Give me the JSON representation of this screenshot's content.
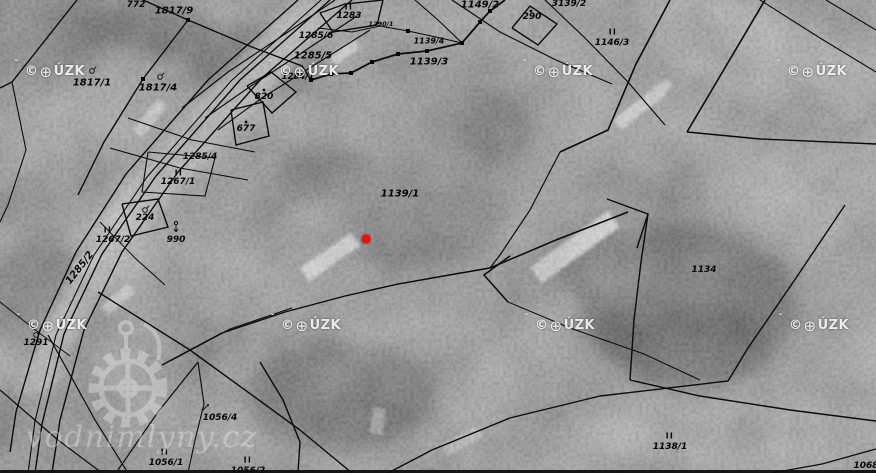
{
  "map": {
    "marker": {
      "x": 366,
      "y": 239,
      "color": "#f40d0d"
    },
    "copyright": {
      "prefix": "©",
      "globe_icon": "⊕",
      "caron": "ˇ",
      "suffix": "ÚZK",
      "positions": [
        {
          "x": 25,
          "y": 64
        },
        {
          "x": 279,
          "y": 64
        },
        {
          "x": 533,
          "y": 64
        },
        {
          "x": 787,
          "y": 64
        },
        {
          "x": 27,
          "y": 318
        },
        {
          "x": 281,
          "y": 318
        },
        {
          "x": 535,
          "y": 318
        },
        {
          "x": 789,
          "y": 318
        }
      ]
    },
    "site_watermark": {
      "text": "vodnimlyny.cz"
    },
    "parcel_labels": [
      {
        "text": "772",
        "x": 136,
        "y": 5
      },
      {
        "text": "1817/9",
        "x": 174,
        "y": 11,
        "size": 10
      },
      {
        "text": "1817/1",
        "x": 92,
        "y": 83,
        "size": 10
      },
      {
        "text": "1817/4",
        "x": 158,
        "y": 88,
        "size": 10
      },
      {
        "text": "820",
        "x": 264,
        "y": 97
      },
      {
        "text": "677",
        "x": 246,
        "y": 129
      },
      {
        "text": "1285/4",
        "x": 200,
        "y": 157
      },
      {
        "text": "II",
        "x": 349,
        "y": 7,
        "kind": "roman"
      },
      {
        "text": "1283",
        "x": 349,
        "y": 16
      },
      {
        "text": "1290/1",
        "x": 381,
        "y": 24,
        "size": 6.5
      },
      {
        "text": "1285/6",
        "x": 316,
        "y": 36
      },
      {
        "text": "1285/5",
        "x": 313,
        "y": 56,
        "size": 10
      },
      {
        "text": "1284/1",
        "x": 298,
        "y": 77,
        "size": 8.5
      },
      {
        "text": "1139/4",
        "x": 429,
        "y": 41,
        "size": 8
      },
      {
        "text": "1139/3",
        "x": 429,
        "y": 62,
        "size": 10
      },
      {
        "text": "1149/2",
        "x": 480,
        "y": 5,
        "size": 10
      },
      {
        "text": "290",
        "x": 532,
        "y": 17
      },
      {
        "text": "3139/2",
        "x": 569,
        "y": 4
      },
      {
        "text": "II",
        "x": 613,
        "y": 32,
        "kind": "roman"
      },
      {
        "text": "1146/3",
        "x": 612,
        "y": 43
      },
      {
        "text": "1139/1",
        "x": 400,
        "y": 194,
        "size": 10
      },
      {
        "text": "II",
        "x": 179,
        "y": 173,
        "kind": "roman"
      },
      {
        "text": "1267/1",
        "x": 178,
        "y": 182
      },
      {
        "text": "224",
        "x": 145,
        "y": 218
      },
      {
        "text": "II",
        "x": 108,
        "y": 230,
        "kind": "roman"
      },
      {
        "text": "1267/2",
        "x": 113,
        "y": 240
      },
      {
        "text": "990",
        "x": 176,
        "y": 240
      },
      {
        "text": "1285/2",
        "x": 80,
        "y": 268,
        "rot": -52,
        "size": 10
      },
      {
        "text": "1291",
        "x": 36,
        "y": 343
      },
      {
        "text": "1134",
        "x": 704,
        "y": 270
      },
      {
        "text": "1056/4",
        "x": 220,
        "y": 418
      },
      {
        "text": "II",
        "x": 165,
        "y": 452,
        "kind": "roman"
      },
      {
        "text": "1056/1",
        "x": 166,
        "y": 463
      },
      {
        "text": "II",
        "x": 248,
        "y": 460,
        "kind": "roman"
      },
      {
        "text": "1056/2",
        "x": 248,
        "y": 471
      },
      {
        "text": "II",
        "x": 670,
        "y": 436,
        "kind": "roman"
      },
      {
        "text": "1138/1",
        "x": 670,
        "y": 447
      },
      {
        "text": "1068",
        "x": 866,
        "y": 466
      }
    ],
    "point_symbols": [
      {
        "type": "tree",
        "x": 92,
        "y": 71
      },
      {
        "type": "tree",
        "x": 160,
        "y": 77
      },
      {
        "type": "dot",
        "x": 264,
        "y": 90
      },
      {
        "type": "dot",
        "x": 246,
        "y": 122
      },
      {
        "type": "dot",
        "x": 531,
        "y": 11
      },
      {
        "type": "tree",
        "x": 145,
        "y": 210
      },
      {
        "type": "arrow-down",
        "x": 176,
        "y": 229
      },
      {
        "type": "tree",
        "x": 36,
        "y": 335
      },
      {
        "type": "mark",
        "x": 205,
        "y": 408
      }
    ],
    "survey_points": [
      [
        188,
        20
      ],
      [
        143,
        79
      ],
      [
        490,
        11
      ],
      [
        480,
        22
      ],
      [
        462,
        43
      ],
      [
        427,
        51
      ],
      [
        398,
        54
      ],
      [
        372,
        62
      ],
      [
        351,
        73
      ],
      [
        331,
        74
      ],
      [
        311,
        80
      ],
      [
        408,
        31
      ]
    ]
  }
}
